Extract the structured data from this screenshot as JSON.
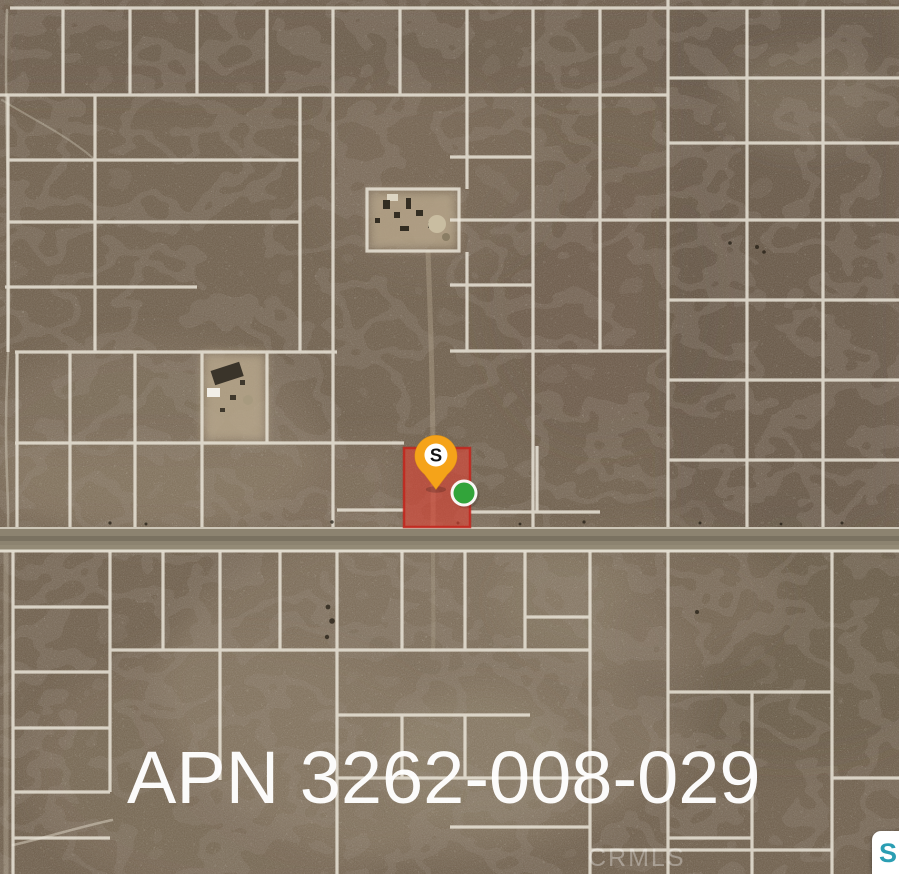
{
  "map": {
    "apn_label": "APN 3262-008-029",
    "watermark": "CRMLS",
    "pin": {
      "letter": "S",
      "color": "#F5A319",
      "inner_circle": "#FFFFFF",
      "letter_color": "#141414"
    },
    "highlight_parcel": {
      "fill": "#E04334",
      "stroke": "#C3241C",
      "fill_opacity": "0.6"
    },
    "green_dot": {
      "fill": "#32A43A",
      "ring": "#FFFFFF"
    },
    "logo_badge": {
      "letter": "S",
      "letter_color": "#2B9EB3",
      "background": "#FFFFFF"
    },
    "terrain": {
      "base": "#6F5F4C",
      "parcel_line": "#EDE8DC",
      "road_fill": "#8C8370"
    }
  }
}
